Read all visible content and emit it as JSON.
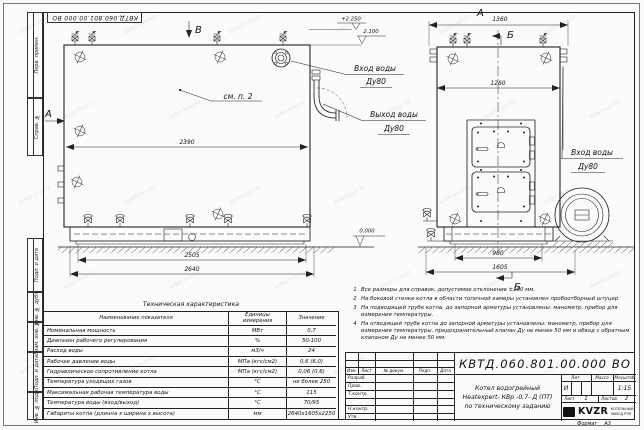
{
  "sheet": {
    "top_stamp": "КВТД.060.801.00.000 ВО",
    "format_label": "Формат",
    "format_value": "А3",
    "strip": [
      "Перв. примен.",
      "Справ. №",
      "Подп. и дата",
      "Инв. № дубл.",
      "Взам. инв. №",
      "Подп. и дата",
      "Инв. № подл."
    ]
  },
  "watermark": {
    "text": "kotel-kvzr.kz"
  },
  "drawing": {
    "view_labels": {
      "top": "В",
      "left": "А",
      "side_title": "А",
      "section": "Б"
    },
    "see_note": "см. п. 2",
    "ports": {
      "inlet_front": {
        "line1": "Вход воды",
        "line2": "Ду80"
      },
      "outlet_front": {
        "line1": "Выход воды",
        "line2": "Ду80"
      },
      "inlet_side": {
        "line1": "Вход воды",
        "line2": "Ду80"
      }
    },
    "elevations": {
      "top": "+2.250",
      "mid": "2.100",
      "ground": "0.000"
    },
    "dims": {
      "front_width": "2390",
      "front_base": "2505",
      "front_total": "2640",
      "side_flanges": "1360",
      "side_width": "1260",
      "side_base": "980",
      "side_total": "1605"
    }
  },
  "notes": {
    "items": [
      {
        "n": "1",
        "text": "Все размеры для справок, допустимое отклонение ±100 мм."
      },
      {
        "n": "2",
        "text": "На боковой стенке котла в области топочной камеры установлен пробоотборный штуцер"
      },
      {
        "n": "3",
        "text": "На подводящей трубе котла, до запорной арматуры установлены: манометр, прибор для измерения температуры."
      },
      {
        "n": "4",
        "text": "На отводящей трубе котла до запорной арматуры установлены: манометр, прибор для измерения температуры, предохранительный клапан Ду не менее 50 мм и обвод с обратным клапаном Ду не менее 50 мм."
      }
    ]
  },
  "tech_table": {
    "title": "Техническая характеристика",
    "headers": {
      "name": "Наименование показателя",
      "units": "Единицы измерения",
      "value": "Значение"
    },
    "rows": [
      {
        "name": "Номинальная мощность",
        "units": "МВт",
        "value": "0,7"
      },
      {
        "name": "Диапазон рабочего регулирования",
        "units": "%",
        "value": "50-100"
      },
      {
        "name": "Расход воды",
        "units": "м3/ч",
        "value": "24"
      },
      {
        "name": "Рабочее давление воды",
        "units": "МПа (кгс/см2)",
        "value": "0,6 (6,0)"
      },
      {
        "name": "Гидравлическое сопротивление котла",
        "units": "МПа (кгс/см2)",
        "value": "0,06 (0,6)"
      },
      {
        "name": "Температура уходящих газов",
        "units": "°С",
        "value": "не более 250"
      },
      {
        "name": "Максимальная рабочая температура воды",
        "units": "°С",
        "value": "115"
      },
      {
        "name": "Температура воды (вход/выход)",
        "units": "°С",
        "value": "70/95"
      },
      {
        "name": "Габариты котла (длинна х ширина х высота)",
        "units": "мм",
        "value": "2640х1605х2250"
      }
    ]
  },
  "title_block": {
    "doc_number": "КВТД.060.801.00.000 ВО",
    "name_line1": "Котел водогрейный",
    "name_line2": "Heatexpert- КВр -0,7- Д (ПТ)",
    "name_line3": "по техническому заданию",
    "rev_headers": {
      "izm": "Изм.",
      "list": "Лист",
      "doc": "№ докум.",
      "sign": "Подп.",
      "date": "Дата"
    },
    "roles": [
      "Разраб.",
      "Пров.",
      "Т.контр.",
      " ",
      "Н.контр.",
      "Утв."
    ],
    "lit_header": "Лит.",
    "mass_header": "Масса",
    "scale_header": "Масштаб",
    "lit": "И",
    "scale": "1:15",
    "sheet_label": "Лист",
    "sheet_value": "1",
    "sheets_label": "Листов",
    "sheets_value": "2",
    "logo": "KVZR",
    "logo_line1": "КОТЕЛЬНЫЙ",
    "logo_line2": "ЗАВОД РЭП"
  }
}
